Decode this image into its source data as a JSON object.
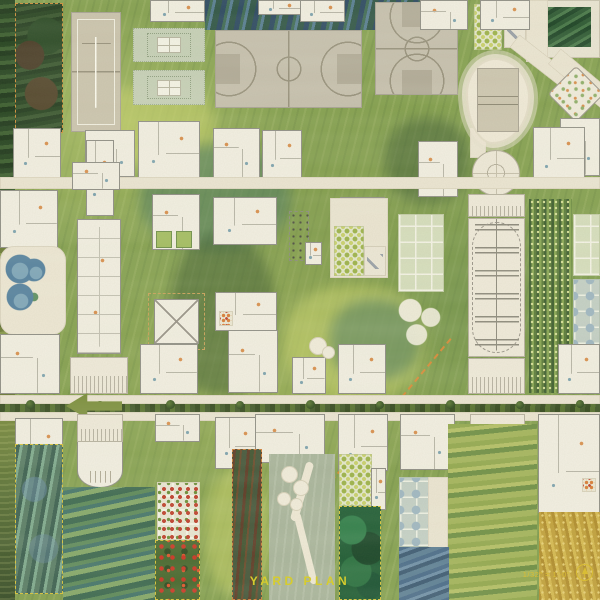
{
  "title": {
    "text": "YARD PLAN",
    "color": "#d6cc2e"
  },
  "scale_note": {
    "text": "1/32\" = 1'-0\"",
    "color": "#d9bd35"
  },
  "palette": {
    "ground_green": "#85a050",
    "court_beige": "#c6bfae",
    "walkway_cream": "#ebe4d2",
    "building_white": "#f2eee2",
    "pool_blue": "#54809f",
    "hedge_green": "#35491f",
    "poppy_red": "#cc3524",
    "wheat_gold": "#c7a43c",
    "annotation_yellow": "#d9bd35",
    "dash_orange": "#cf8f3a",
    "night_blue": "#2c4862"
  },
  "plan": {
    "width": 600,
    "height": 600,
    "names": {
      "band": "painted-band",
      "patch": "paint-patch",
      "darkplot": "fenced-grove",
      "tennis": "tennis-court",
      "bball": "basketball-court",
      "bballv": "basketball-court",
      "lawnp": "lawn-panel",
      "orchard": "orchard-plot",
      "terrace": "sun-terrace",
      "cyard": "courtyard-building",
      "poolblob": "pool-deck",
      "vbcourt": "volleyball-court",
      "path": "walkway",
      "plaza": "circular-plaza",
      "rotpav": "rotated-pavilion",
      "frag": "building-fragment",
      "house": "house-plan",
      "longb": "community-building",
      "gpair": "garden-beds",
      "pav": "pavilion",
      "pergola": "pergola-building",
      "poolc": "swimming-pools",
      "barracks": "row-building",
      "vineyard": "vineyard-rows",
      "ggrid": "allotment-grid",
      "ggridb": "allotment-grid-blue",
      "canopy": "tree-canopies",
      "hedge": "road-hedge",
      "tree": "hedge-tree",
      "arrow": "road-arrow",
      "dashline": "boundary-dash-line",
      "ucourt": "curved-court-building",
      "iris": "iris-field",
      "flowerg": "flower-bed-grid",
      "poppy": "poppy-field",
      "redgreen": "scrub-field",
      "sage": "winding-path-yard",
      "pad": "paved-pad",
      "forest": "dense-grove",
      "swirl": "painted-meadow",
      "wheat": "wheat-field",
      "minif": "flower-patch",
      "dotstrip": "planted-strip"
    },
    "features": [
      {
        "t": "band",
        "v": "b-forest",
        "x": 0,
        "y": 0,
        "w": 15,
        "h": 235
      },
      {
        "t": "band",
        "v": "b-olive",
        "x": 0,
        "y": 235,
        "w": 15,
        "h": 165
      },
      {
        "t": "band",
        "v": "b-mixed",
        "x": 0,
        "y": 400,
        "w": 15,
        "h": 200
      },
      {
        "t": "band",
        "v": "b-blue",
        "x": 205,
        "y": 0,
        "w": 255,
        "h": 30
      },
      {
        "t": "patch",
        "v": "patch p-yel",
        "x": 95,
        "y": 85,
        "w": 120,
        "h": 80
      },
      {
        "t": "patch",
        "v": "patch p-teal",
        "x": 140,
        "y": 145,
        "w": 150,
        "h": 105
      },
      {
        "t": "patch",
        "v": "patch p-dark",
        "x": 170,
        "y": 235,
        "w": 105,
        "h": 160
      },
      {
        "t": "patch",
        "v": "patch p-yel",
        "x": 285,
        "y": 285,
        "w": 140,
        "h": 115
      },
      {
        "t": "patch",
        "v": "patch p-dark",
        "x": 385,
        "y": 118,
        "w": 85,
        "h": 85
      },
      {
        "t": "patch",
        "v": "patch p-teal",
        "x": 330,
        "y": 300,
        "w": 90,
        "h": 80
      },
      {
        "t": "patch",
        "v": "patch p-yel",
        "x": 205,
        "y": 470,
        "w": 65,
        "h": 125
      },
      {
        "t": "darkplot",
        "x": 15,
        "y": 3,
        "w": 48,
        "h": 130
      },
      {
        "t": "tennis",
        "x": 71,
        "y": 12,
        "w": 50,
        "h": 120
      },
      {
        "t": "lawnp",
        "x": 133,
        "y": 28,
        "w": 72,
        "h": 34
      },
      {
        "t": "lawnp",
        "x": 133,
        "y": 70,
        "w": 72,
        "h": 35
      },
      {
        "t": "bball",
        "x": 215,
        "y": 30,
        "w": 147,
        "h": 78
      },
      {
        "t": "bballv",
        "x": 375,
        "y": 2,
        "w": 83,
        "h": 93
      },
      {
        "t": "orchard",
        "x": 474,
        "y": 4,
        "w": 28,
        "h": 46
      },
      {
        "t": "terrace",
        "x": 504,
        "y": 6,
        "w": 22,
        "h": 42
      },
      {
        "t": "cyard",
        "x": 533,
        "y": 0,
        "w": 67,
        "h": 58
      },
      {
        "t": "path",
        "x": 526,
        "y": 0,
        "w": 22,
        "h": 62
      },
      {
        "t": "path",
        "x": 508,
        "y": 52,
        "w": 62,
        "h": 16,
        "r": 38
      },
      {
        "t": "path",
        "x": 545,
        "y": 72,
        "w": 80,
        "h": 20,
        "r": 40
      },
      {
        "t": "path",
        "x": 470,
        "y": 128,
        "w": 16,
        "h": 30
      },
      {
        "t": "poolblob",
        "x": 466,
        "y": 58,
        "w": 64,
        "h": 86
      },
      {
        "t": "vbcourt",
        "x": 477,
        "y": 68,
        "w": 42,
        "h": 64
      },
      {
        "t": "plaza",
        "x": 472,
        "y": 150,
        "w": 48,
        "h": 46
      },
      {
        "t": "rotpav",
        "x": 556,
        "y": 74,
        "w": 40,
        "h": 40,
        "r": 45
      },
      {
        "t": "frag",
        "x": 150,
        "y": 0,
        "w": 55,
        "h": 22
      },
      {
        "t": "frag",
        "x": 258,
        "y": 0,
        "w": 46,
        "h": 15
      },
      {
        "t": "frag",
        "x": 300,
        "y": 0,
        "w": 45,
        "h": 22
      },
      {
        "t": "house",
        "v": "v2",
        "x": 420,
        "y": 0,
        "w": 48,
        "h": 30
      },
      {
        "t": "house",
        "x": 480,
        "y": 0,
        "w": 50,
        "h": 30
      },
      {
        "t": "house",
        "v": "v2",
        "x": 560,
        "y": 118,
        "w": 40,
        "h": 58
      },
      {
        "t": "house",
        "x": 533,
        "y": 127,
        "w": 52,
        "h": 55
      },
      {
        "t": "house",
        "v": "v2",
        "x": 418,
        "y": 141,
        "w": 40,
        "h": 56
      },
      {
        "t": "house",
        "x": 13,
        "y": 128,
        "w": 48,
        "h": 50
      },
      {
        "t": "house",
        "v": "v2",
        "x": 85,
        "y": 130,
        "w": 50,
        "h": 47
      },
      {
        "t": "house",
        "x": 138,
        "y": 121,
        "w": 62,
        "h": 57
      },
      {
        "t": "house",
        "v": "v2",
        "x": 213,
        "y": 128,
        "w": 47,
        "h": 51
      },
      {
        "t": "house",
        "x": 262,
        "y": 130,
        "w": 40,
        "h": 50
      },
      {
        "t": "path",
        "x": 0,
        "y": 177,
        "w": 600,
        "h": 12
      },
      {
        "t": "house",
        "x": 86,
        "y": 140,
        "w": 28,
        "h": 76
      },
      {
        "t": "house",
        "v": "v2",
        "x": 72,
        "y": 162,
        "w": 48,
        "h": 28
      },
      {
        "t": "house",
        "x": 0,
        "y": 190,
        "w": 58,
        "h": 58
      },
      {
        "t": "house",
        "v": "v2",
        "x": 152,
        "y": 194,
        "w": 48,
        "h": 56
      },
      {
        "t": "house",
        "x": 213,
        "y": 197,
        "w": 64,
        "h": 48
      },
      {
        "t": "house",
        "v": "v2",
        "x": 340,
        "y": 197,
        "w": 45,
        "h": 43
      },
      {
        "t": "path",
        "x": 330,
        "y": 198,
        "w": 58,
        "h": 80
      },
      {
        "t": "orchard",
        "x": 334,
        "y": 226,
        "w": 30,
        "h": 50
      },
      {
        "t": "terrace",
        "x": 364,
        "y": 246,
        "w": 22,
        "h": 30
      },
      {
        "t": "ggrid",
        "x": 398,
        "y": 214,
        "w": 46,
        "h": 78
      },
      {
        "t": "canopy",
        "x": 394,
        "y": 293,
        "w": 54,
        "h": 58
      },
      {
        "t": "pergola",
        "x": 468,
        "y": 194,
        "w": 57,
        "h": 23
      },
      {
        "t": "barracks",
        "x": 468,
        "y": 218,
        "w": 57,
        "h": 139
      },
      {
        "t": "pergola",
        "x": 468,
        "y": 358,
        "w": 57,
        "h": 36
      },
      {
        "t": "vineyard",
        "x": 529,
        "y": 199,
        "w": 43,
        "h": 194
      },
      {
        "t": "ggrid",
        "x": 573,
        "y": 214,
        "w": 27,
        "h": 62
      },
      {
        "t": "ggridb",
        "x": 573,
        "y": 279,
        "w": 27,
        "h": 66
      },
      {
        "t": "house",
        "x": 558,
        "y": 344,
        "w": 42,
        "h": 50
      },
      {
        "t": "poolc",
        "x": 0,
        "y": 246,
        "w": 66,
        "h": 89
      },
      {
        "t": "house",
        "v": "v2",
        "x": 0,
        "y": 334,
        "w": 60,
        "h": 60
      },
      {
        "t": "longb",
        "x": 77,
        "y": 219,
        "w": 44,
        "h": 135
      },
      {
        "t": "gpair",
        "x": 154,
        "y": 229,
        "w": 40,
        "h": 21
      },
      {
        "t": "pav",
        "x": 154,
        "y": 299,
        "w": 45,
        "h": 45
      },
      {
        "t": "house",
        "x": 140,
        "y": 344,
        "w": 58,
        "h": 50
      },
      {
        "t": "pergola",
        "x": 70,
        "y": 357,
        "w": 58,
        "h": 37
      },
      {
        "t": "dotstrip",
        "x": 289,
        "y": 211,
        "w": 20,
        "h": 50
      },
      {
        "t": "frag",
        "x": 305,
        "y": 242,
        "w": 17,
        "h": 23
      },
      {
        "t": "house",
        "x": 215,
        "y": 292,
        "w": 62,
        "h": 39
      },
      {
        "t": "minif",
        "x": 219,
        "y": 311,
        "w": 14,
        "h": 15
      },
      {
        "t": "house",
        "v": "v2",
        "x": 228,
        "y": 330,
        "w": 50,
        "h": 63
      },
      {
        "t": "house",
        "x": 292,
        "y": 357,
        "w": 34,
        "h": 37
      },
      {
        "t": "pad",
        "x": 309,
        "y": 337,
        "w": 18,
        "h": 18
      },
      {
        "t": "pad",
        "x": 322,
        "y": 346,
        "w": 13,
        "h": 13
      },
      {
        "t": "house",
        "x": 338,
        "y": 344,
        "w": 48,
        "h": 50
      },
      {
        "t": "dashline",
        "x": 298,
        "y": 409,
        "w": 186,
        "h": 2,
        "r": -50
      },
      {
        "t": "path",
        "x": 0,
        "y": 395,
        "w": 600,
        "h": 9
      },
      {
        "t": "hedge",
        "x": 0,
        "y": 404,
        "w": 600,
        "h": 8
      },
      {
        "t": "tree",
        "x": 26,
        "y": 400,
        "w": 9,
        "h": 9
      },
      {
        "t": "tree",
        "x": 96,
        "y": 401,
        "w": 8,
        "h": 8
      },
      {
        "t": "tree",
        "x": 166,
        "y": 400,
        "w": 9,
        "h": 9
      },
      {
        "t": "tree",
        "x": 236,
        "y": 401,
        "w": 8,
        "h": 8
      },
      {
        "t": "tree",
        "x": 306,
        "y": 400,
        "w": 9,
        "h": 9
      },
      {
        "t": "tree",
        "x": 376,
        "y": 401,
        "w": 8,
        "h": 8
      },
      {
        "t": "tree",
        "x": 446,
        "y": 400,
        "w": 9,
        "h": 9
      },
      {
        "t": "tree",
        "x": 516,
        "y": 401,
        "w": 8,
        "h": 8
      },
      {
        "t": "tree",
        "x": 576,
        "y": 400,
        "w": 8,
        "h": 8
      },
      {
        "t": "path",
        "x": 0,
        "y": 412,
        "w": 600,
        "h": 9
      },
      {
        "t": "arrow",
        "x": 66,
        "y": 393,
        "w": 56,
        "h": 26
      },
      {
        "t": "house",
        "x": 15,
        "y": 418,
        "w": 48,
        "h": 60
      },
      {
        "t": "pergola",
        "x": 77,
        "y": 414,
        "w": 46,
        "h": 28
      },
      {
        "t": "ucourt",
        "x": 77,
        "y": 442,
        "w": 46,
        "h": 46
      },
      {
        "t": "house",
        "v": "v2",
        "x": 155,
        "y": 414,
        "w": 45,
        "h": 28
      },
      {
        "t": "house",
        "x": 215,
        "y": 417,
        "w": 45,
        "h": 52
      },
      {
        "t": "house",
        "v": "v2",
        "x": 255,
        "y": 414,
        "w": 70,
        "h": 49
      },
      {
        "t": "house",
        "x": 338,
        "y": 414,
        "w": 50,
        "h": 57
      },
      {
        "t": "house",
        "v": "v2",
        "x": 400,
        "y": 414,
        "w": 55,
        "h": 56
      },
      {
        "t": "pergola",
        "x": 470,
        "y": 414,
        "w": 55,
        "h": 28
      },
      {
        "t": "house",
        "x": 538,
        "y": 414,
        "w": 62,
        "h": 99
      },
      {
        "t": "minif",
        "x": 582,
        "y": 478,
        "w": 14,
        "h": 14
      },
      {
        "t": "iris",
        "x": 15,
        "y": 444,
        "w": 48,
        "h": 150
      },
      {
        "t": "swirl",
        "v": "s-bg",
        "x": 63,
        "y": 487,
        "w": 92,
        "h": 113
      },
      {
        "t": "flowerg",
        "x": 157,
        "y": 482,
        "w": 43,
        "h": 58
      },
      {
        "t": "poppy",
        "x": 155,
        "y": 540,
        "w": 45,
        "h": 60
      },
      {
        "t": "redgreen",
        "x": 232,
        "y": 449,
        "w": 30,
        "h": 151
      },
      {
        "t": "sage",
        "x": 269,
        "y": 454,
        "w": 66,
        "h": 146
      },
      {
        "t": "pad",
        "x": 281,
        "y": 466,
        "w": 17,
        "h": 17
      },
      {
        "t": "pad",
        "x": 293,
        "y": 480,
        "w": 16,
        "h": 16
      },
      {
        "t": "pad",
        "x": 277,
        "y": 492,
        "w": 14,
        "h": 14
      },
      {
        "t": "pad",
        "x": 290,
        "y": 498,
        "w": 13,
        "h": 13
      },
      {
        "t": "orchard",
        "x": 339,
        "y": 454,
        "w": 33,
        "h": 52
      },
      {
        "t": "frag",
        "x": 371,
        "y": 468,
        "w": 15,
        "h": 42
      },
      {
        "t": "forest",
        "x": 339,
        "y": 506,
        "w": 42,
        "h": 94
      },
      {
        "t": "ggridb",
        "x": 399,
        "y": 477,
        "w": 52,
        "h": 70
      },
      {
        "t": "path",
        "x": 428,
        "y": 477,
        "w": 20,
        "h": 84
      },
      {
        "t": "swirl",
        "v": "s-yel",
        "x": 448,
        "y": 424,
        "w": 89,
        "h": 176
      },
      {
        "t": "swirl",
        "v": "s-blu",
        "x": 399,
        "y": 547,
        "w": 50,
        "h": 53
      },
      {
        "t": "wheat",
        "x": 539,
        "y": 512,
        "w": 61,
        "h": 88
      }
    ]
  }
}
